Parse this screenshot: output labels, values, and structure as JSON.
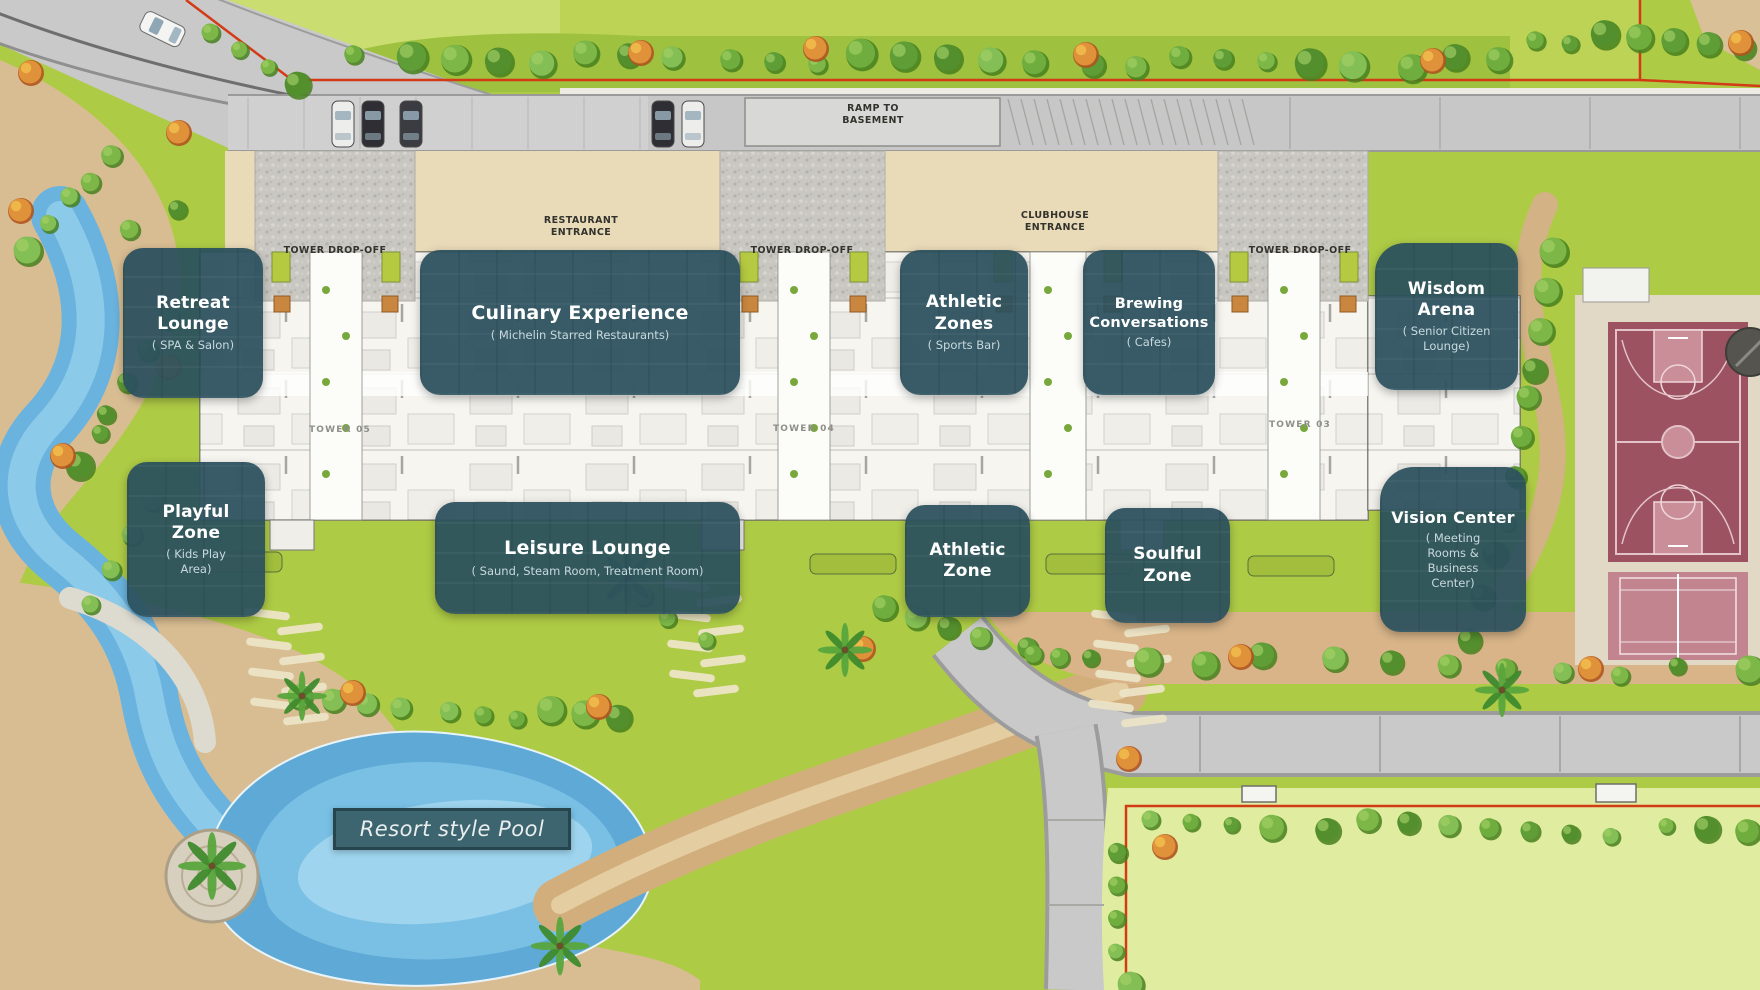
{
  "map": {
    "region_labels": {
      "ramp": "RAMP TO BASEMENT",
      "restaurant_entrance": "RESTAURANT ENTRANCE",
      "clubhouse_entrance": "CLUBHOUSE ENTRANCE",
      "tower_dropoff": "TOWER DROP-OFF",
      "pool": "Resort style Pool"
    },
    "towers": [
      "TOWER 05",
      "TOWER 04",
      "TOWER 03"
    ],
    "callouts": [
      {
        "id": "retreat-lounge",
        "title": "Retreat Lounge",
        "subtitle": "( SPA & Salon)"
      },
      {
        "id": "culinary-experience",
        "title": "Culinary Experience",
        "subtitle": "( Michelin Starred Restaurants)"
      },
      {
        "id": "athletic-zones",
        "title": "Athletic Zones",
        "subtitle": "( Sports Bar)"
      },
      {
        "id": "brewing-conversations",
        "title": "Brewing Conversations",
        "subtitle": "( Cafes)"
      },
      {
        "id": "wisdom-arena",
        "title": "Wisdom Arena",
        "subtitle": "( Senior Citizen Lounge)"
      },
      {
        "id": "playful-zone",
        "title": "Playful Zone",
        "subtitle": "( Kids Play Area)"
      },
      {
        "id": "leisure-lounge",
        "title": "Leisure Lounge",
        "subtitle": "( Saund, Steam Room, Treatment Room)"
      },
      {
        "id": "athletic-zone",
        "title": "Athletic Zone",
        "subtitle": ""
      },
      {
        "id": "soulful-zone",
        "title": "Soulful Zone",
        "subtitle": ""
      },
      {
        "id": "vision-center",
        "title": "Vision Center",
        "subtitle": "( Meeting Rooms & Business Center)"
      }
    ],
    "colors": {
      "callout_bg": "#2c515d",
      "callout_title": "#ffffff",
      "callout_subtitle": "#c7d9dd",
      "boundary_red": "#d23b16",
      "water_blue": "#6ab3de",
      "lawn_green": "#aecb45",
      "light_lawn": "#e0ec9f",
      "road_gray": "#c7c7c7",
      "path_tan": "#d5b183",
      "basketball_court": "#9c5260",
      "tennis_court": "#c2858f",
      "pool_label_bg": "#3c656f"
    }
  }
}
